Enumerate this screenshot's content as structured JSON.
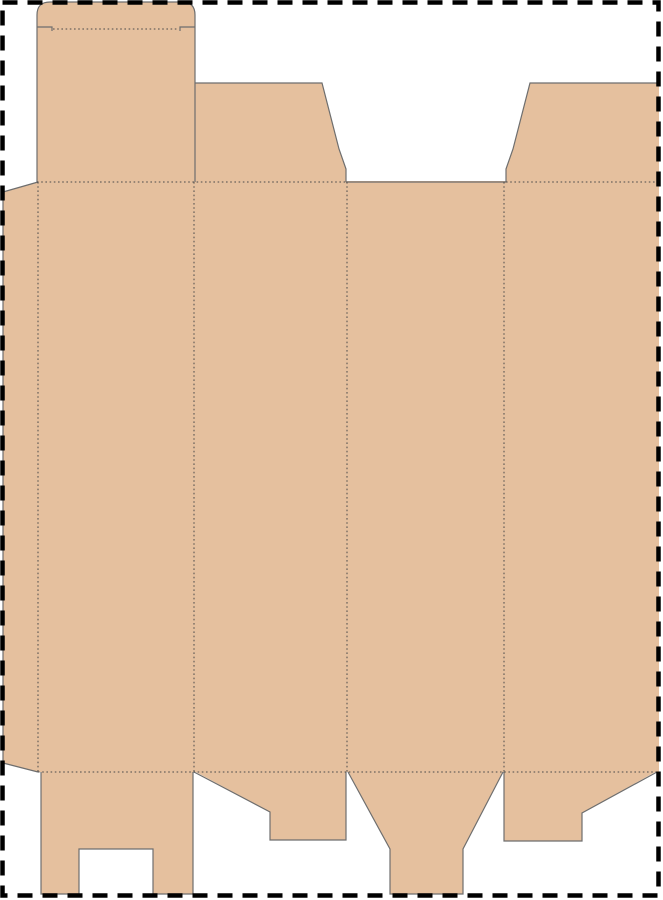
{
  "document": {
    "kind": "packaging-dieline-template",
    "page": {
      "width_px": 663,
      "height_px": 900,
      "background": "#ffffff"
    }
  },
  "colors": {
    "cardboard_fill": "#e5c09e",
    "cut_line": "#6e6e6e",
    "fold_line": "#4a4a4a",
    "page_border": "#000000"
  },
  "dieline": {
    "parts": [
      "glue-flap",
      "tuck-flap",
      "tuck-flap-slit-left",
      "tuck-flap-slit-right",
      "dust-flap-left",
      "dust-flap-right",
      "carton-body-panels",
      "bottom-flap-panel-1",
      "bottom-flap-panel-2",
      "bottom-tongue-panel-3",
      "bottom-flap-panel-4"
    ],
    "fold_lines": [
      "fold-top-left-section",
      "fold-top-right-section",
      "fold-bottom",
      "fold-glue-edge",
      "fold-panel-1-2",
      "fold-panel-2-3",
      "fold-panel-3-4",
      "fold-tuck-crease"
    ]
  }
}
